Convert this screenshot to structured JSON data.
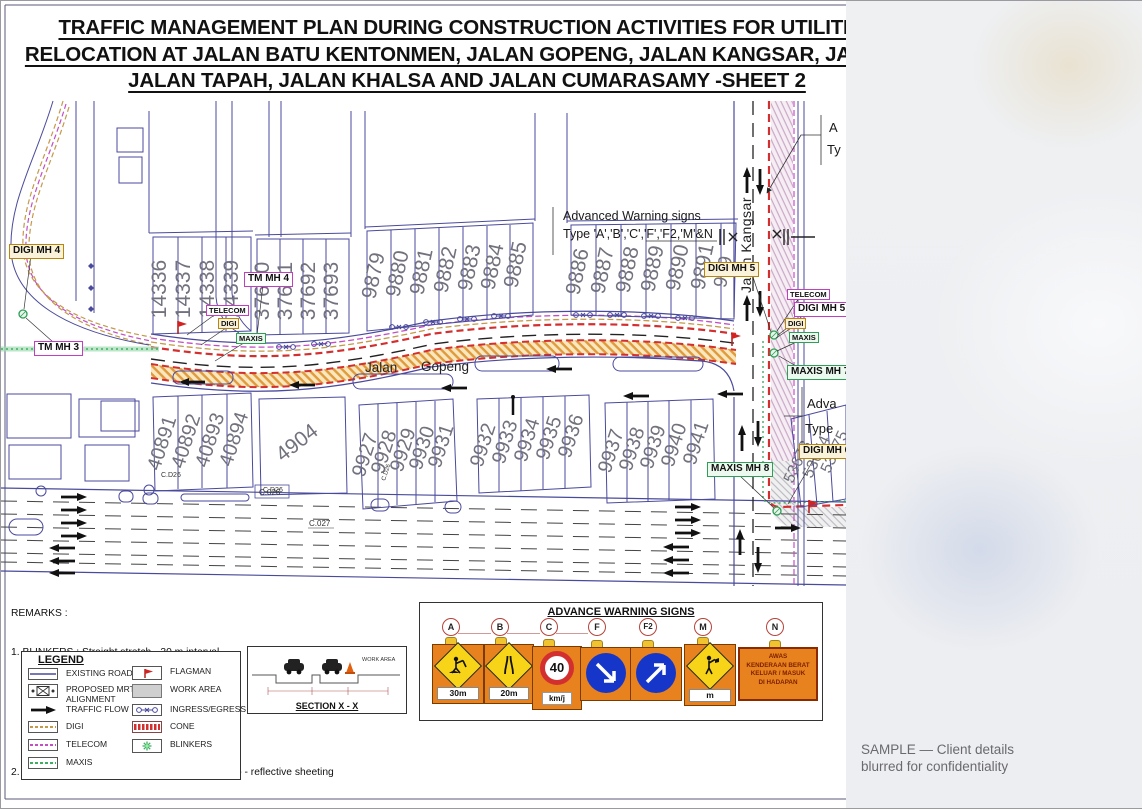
{
  "title": {
    "line1": "TRAFFIC MANAGEMENT PLAN DURING CONSTRUCTION ACTIVITIES FOR UTILITIES",
    "line2": "RELOCATION AT JALAN BATU KENTONMEN, JALAN GOPENG, JALAN KANGSAR, JALAN 1",
    "line3": "JALAN TAPAH, JALAN KHALSA AND JALAN CUMARASAMY -SHEET 2"
  },
  "plan": {
    "roads": {
      "gopeng_1": "Jalan",
      "gopeng_2": "Gopeng",
      "kangsar": "Jalan Kangsar"
    },
    "notes": {
      "adv1": "Advanced Warning signs",
      "adv2": "Type 'A','B','C','F','F2,'M'&N",
      "corner_a": "A",
      "corner_ty": "Ty",
      "br_adva": "Adva",
      "br_type": "Type"
    },
    "labels": {
      "digi_mh4": "DIGI MH 4",
      "tm_mh3": "TM MH 3",
      "tm_mh4": "TM MH 4",
      "telecom": "TELECOM",
      "digi": "DIGI",
      "maxis": "MAXIS",
      "digi_mh5": "DIGI MH 5",
      "maxis_mh7": "MAXIS MH 7",
      "maxis_mh8": "MAXIS MH 8",
      "digi_mh6": "DIGI MH 6"
    },
    "chainage": {
      "cd26": "C.D26",
      "c026": "C.026",
      "c027": "C.027"
    },
    "lots": {
      "g1": [
        "14336",
        "14337",
        "14338",
        "14339"
      ],
      "g2": [
        "37690",
        "37691",
        "37692",
        "37693"
      ],
      "g3": [
        "9879",
        "9880",
        "9881",
        "9882",
        "9883",
        "9884",
        "9885"
      ],
      "g4": [
        "9886",
        "9887",
        "9888",
        "9889",
        "9890",
        "9891",
        "989"
      ],
      "g5": [
        "40891",
        "40892",
        "40893",
        "40894"
      ],
      "g6": [
        "4904"
      ],
      "g7": [
        "9927",
        "9928",
        "9929",
        "9930",
        "9931"
      ],
      "g8": [
        "9932",
        "9933",
        "9934",
        "9935",
        "9936"
      ],
      "g9": [
        "9937",
        "9938",
        "9939",
        "9940",
        "9941"
      ],
      "g10": [
        "53673",
        "53674",
        "53675"
      ]
    }
  },
  "remarks": {
    "heading": "REMARKS :",
    "l1": "1. BLINKERS : Straight stretch - 30 m interval",
    "l2": "              Taper               - 10 m interval",
    "l3": "                  : With delianator string",
    "l4": "2. SIGNAGES : Fluorescent orange prismatic retro - reflective sheeting"
  },
  "legend": {
    "heading": "LEGEND",
    "left": [
      {
        "label": "EXISTING ROAD"
      },
      {
        "label": "PROPOSED MRT ALIGNMENT"
      },
      {
        "label": "TRAFFIC FLOW"
      },
      {
        "label": "DIGI"
      },
      {
        "label": "TELECOM"
      },
      {
        "label": "MAXIS"
      }
    ],
    "right": [
      {
        "label": "FLAGMAN"
      },
      {
        "label": "WORK AREA"
      },
      {
        "label": "INGRESS/EGRESS"
      },
      {
        "label": "CONE"
      },
      {
        "label": "BLINKERS"
      }
    ]
  },
  "section": {
    "title": "SECTION X - X",
    "work_area": "WORK AREA"
  },
  "warning": {
    "title": "ADVANCE WARNING SIGNS",
    "signs": [
      {
        "letter": "A",
        "caption": "30m"
      },
      {
        "letter": "B",
        "caption": "20m"
      },
      {
        "letter": "C",
        "value": "40",
        "caption": "km/j"
      },
      {
        "letter": "F"
      },
      {
        "letter": "F2"
      },
      {
        "letter": "M",
        "caption": "m"
      },
      {
        "letter": "N",
        "lines": [
          "AWAS",
          "KENDERAAN BERAT",
          "KELUAR / MASUK",
          "DI HADAPAN"
        ]
      }
    ]
  },
  "watermark": {
    "line1": "SAMPLE — Client details",
    "line2": "blurred for confidentiality"
  },
  "colors": {
    "road_line": "#4a4a9c",
    "digi": "#c49a4a",
    "telecom": "#c44fc4",
    "maxis": "#3fae62",
    "cone": "#d32f2f",
    "work_fill": "#f9e7bd",
    "sign_orange": "#e8821e",
    "sign_blue": "#1536c9"
  }
}
